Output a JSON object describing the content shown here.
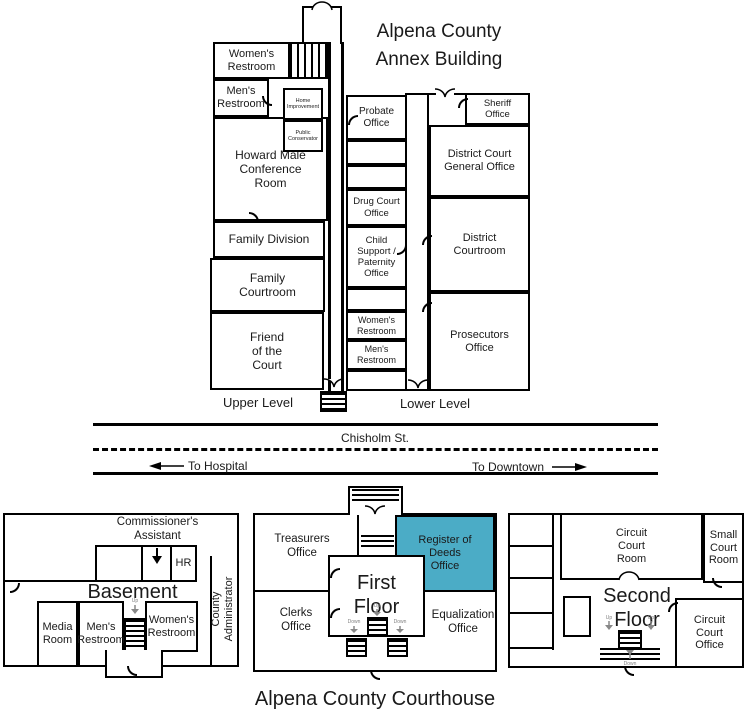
{
  "annex": {
    "title": "Alpena County\nAnnex Building",
    "upper_level": "Upper Level",
    "lower_level": "Lower Level",
    "rooms": {
      "womens_restroom": "Women's\nRestroom",
      "mens_restroom": "Men's\nRestroom",
      "home_improvement": "Home\nImprovement",
      "public_conservator": "Public\nConservator",
      "howard_male_conference": "Howard Male\nConference\nRoom",
      "family_division": "Family Division",
      "family_courtroom": "Family\nCourtroom",
      "friend_of_the_court": "Friend\nof the\nCourt",
      "probate_office": "Probate\nOffice",
      "drug_court_office": "Drug Court\nOffice",
      "child_support": "Child\nSupport /\nPaternity\nOffice",
      "lower_womens_restroom": "Women's\nRestroom",
      "lower_mens_restroom": "Men's\nRestroom",
      "sheriff_office": "Sheriff\nOffice",
      "district_court_general": "District Court\nGeneral Office",
      "district_courtroom": "District\nCourtroom",
      "prosecutors_office": "Prosecutors\nOffice"
    }
  },
  "street": {
    "name": "Chisholm St.",
    "to_hospital": "To Hospital",
    "to_downtown": "To Downtown"
  },
  "courthouse": {
    "title": "Alpena County Courthouse",
    "basement": {
      "label": "Basement",
      "commissioners_assistant": "Commissioner's\nAssistant",
      "hr": "HR",
      "media_room": "Media\nRoom",
      "mens_restroom": "Men's\nRestroom",
      "womens_restroom": "Women's\nRestroom",
      "county_administrator": "County\nAdministrator",
      "stairs_up": "Up"
    },
    "first_floor": {
      "label": "First\nFloor",
      "treasurers_office": "Treasurers\nOffice",
      "register_of_deeds": "Register of\nDeeds\nOffice",
      "clerks_office": "Clerks\nOffice",
      "equalization_office": "Equalization\nOffice",
      "stairs_up": "Up",
      "stairs_down_left": "Down",
      "stairs_down_right": "Down"
    },
    "second_floor": {
      "label": "Second\nFloor",
      "circuit_court_room": "Circuit\nCourt\nRoom",
      "small_court_room": "Small\nCourt\nRoom",
      "circuit_court_office": "Circuit\nCourt\nOffice",
      "stairs_up_left": "Up",
      "stairs_up_right": "Up",
      "stairs_down": "Down"
    }
  },
  "colors": {
    "highlight": "#4BACC6",
    "line": "#000000"
  }
}
